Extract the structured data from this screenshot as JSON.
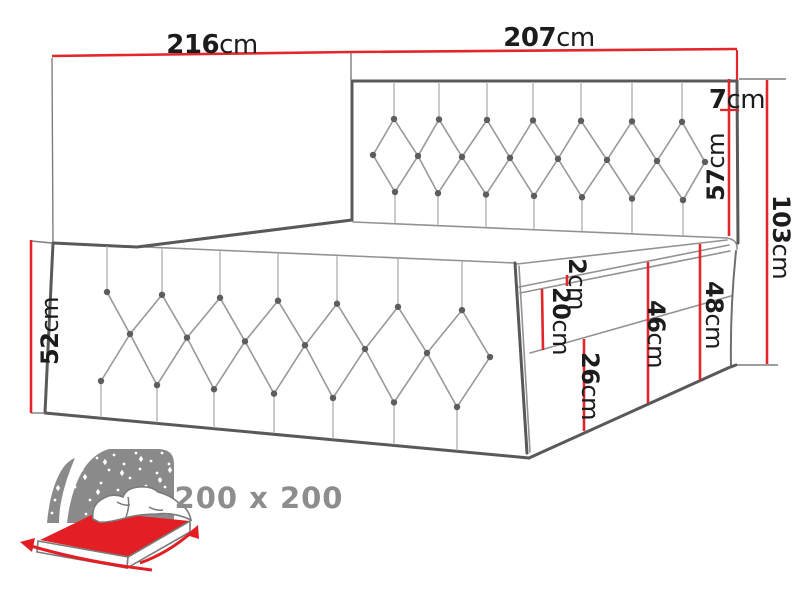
{
  "diagram": {
    "type": "bed-dimension-diagram",
    "dimensions": {
      "length": {
        "value": "216",
        "unit": "cm"
      },
      "width": {
        "value": "207",
        "unit": "cm"
      },
      "headboard_top": {
        "value": "7",
        "unit": "cm"
      },
      "headboard": {
        "value": "57",
        "unit": "cm"
      },
      "total_height": {
        "value": "103",
        "unit": "cm"
      },
      "side_height": {
        "value": "52",
        "unit": "cm"
      },
      "topper": {
        "value": "2",
        "unit": "cm"
      },
      "mattress": {
        "value": "20",
        "unit": "cm"
      },
      "base_upper": {
        "value": "46",
        "unit": "cm"
      },
      "head_height": {
        "value": "48",
        "unit": "cm"
      },
      "base_lower": {
        "value": "26",
        "unit": "cm"
      }
    },
    "size_label": "200 x 200",
    "icon": {
      "name": "bed-size-icon"
    },
    "colors": {
      "dimension_red": "#e2262b",
      "outline_dark": "#58595b",
      "outline_light": "#929292",
      "icon_gray": "#8a8a8a",
      "size_text_gray": "#8d8d8d",
      "label_black": "#1c1c1c",
      "background": "#ffffff"
    }
  }
}
